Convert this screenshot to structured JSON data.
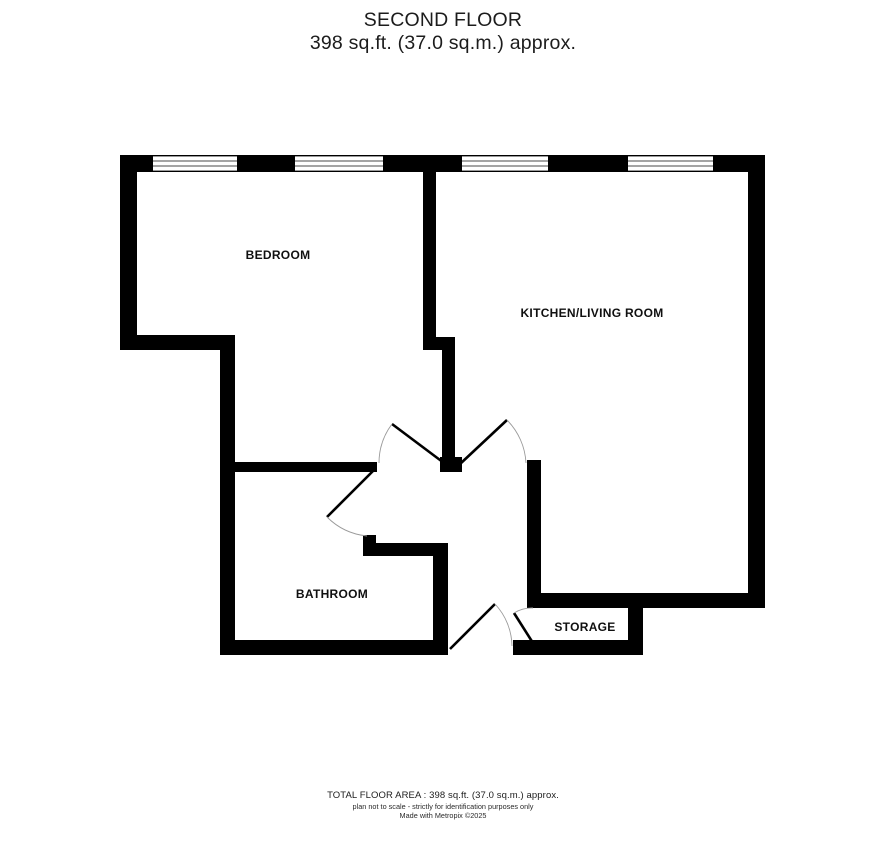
{
  "header": {
    "floor_name": "SECOND FLOOR",
    "floor_area": "398 sq.ft. (37.0 sq.m.) approx."
  },
  "rooms": [
    {
      "name": "BEDROOM"
    },
    {
      "name": "KITCHEN/LIVING ROOM"
    },
    {
      "name": "BATHROOM"
    },
    {
      "name": "STORAGE"
    }
  ],
  "footer": {
    "total_area": "TOTAL FLOOR AREA : 398 sq.ft. (37.0 sq.m.) approx.",
    "disclaimer": "plan not to scale - strictly for identification purposes only",
    "credit": "Made with Metropix ©2025"
  },
  "colors": {
    "wall": "#000000",
    "background": "#ffffff",
    "door_arc": "#9a9a9a"
  }
}
